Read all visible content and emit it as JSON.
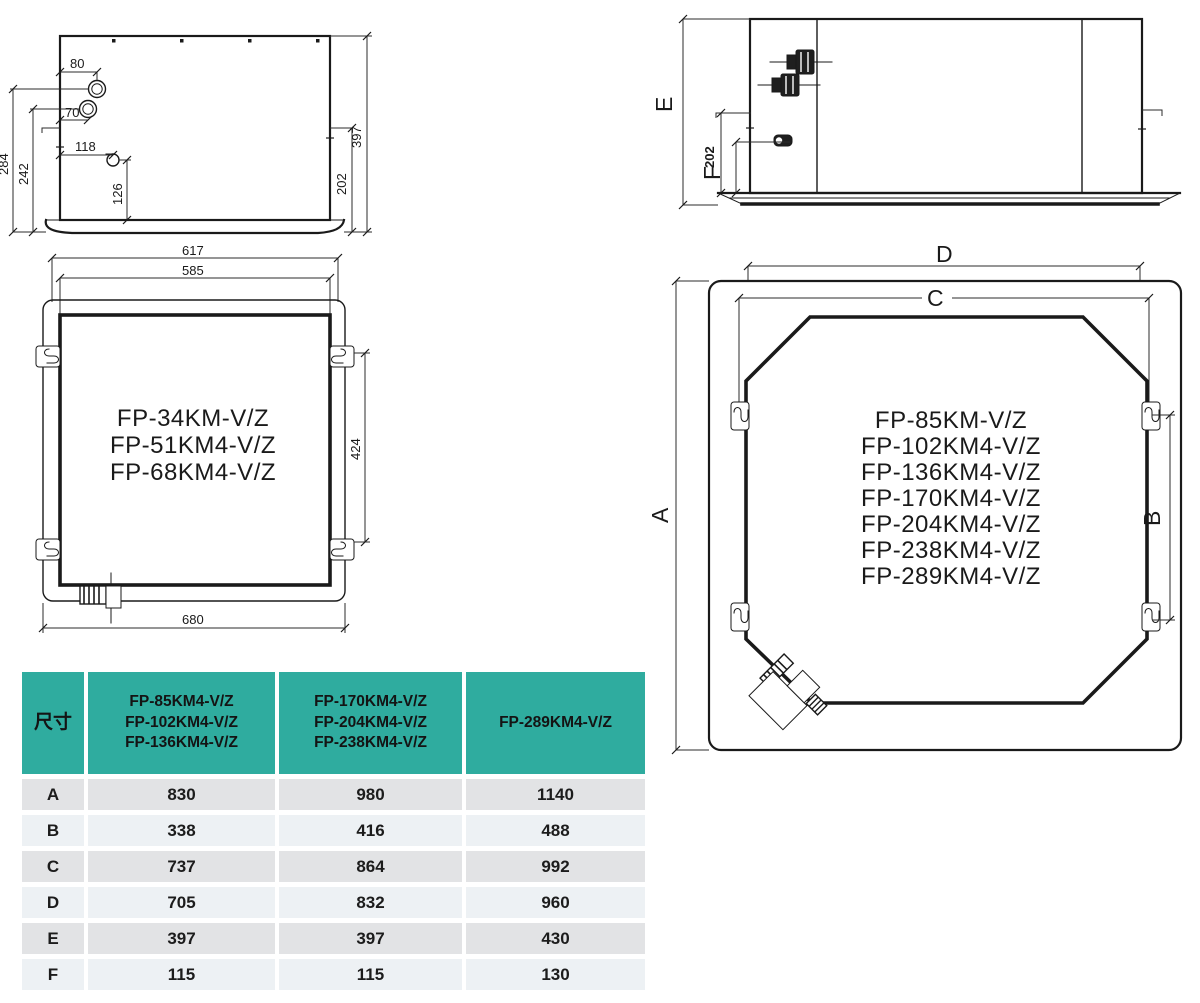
{
  "colors": {
    "accent_teal": "#2FAC9F",
    "row_shade_dark": "#E2E3E5",
    "row_shade_light": "#EDF1F4",
    "line": "#1A1A1A"
  },
  "drawings": {
    "side_small": {
      "dim_80": "80",
      "dim_70": "70",
      "dim_118": "118",
      "dim_126": "126",
      "dim_284": "284",
      "dim_242": "242",
      "dim_397": "397",
      "dim_202": "202"
    },
    "side_large": {
      "dim_E": "E",
      "dim_202": "202",
      "dim_F": "F"
    },
    "plan_small": {
      "dim_617": "617",
      "dim_585": "585",
      "dim_424": "424",
      "dim_680": "680",
      "models": [
        "FP-34KM-V/Z",
        "FP-51KM4-V/Z",
        "FP-68KM4-V/Z"
      ]
    },
    "plan_large": {
      "dim_D": "D",
      "dim_C": "C",
      "dim_A": "A",
      "dim_B": "B",
      "models": [
        "FP-85KM-V/Z",
        "FP-102KM4-V/Z",
        "FP-136KM4-V/Z",
        "FP-170KM4-V/Z",
        "FP-204KM4-V/Z",
        "FP-238KM4-V/Z",
        "FP-289KM4-V/Z"
      ]
    }
  },
  "table": {
    "col_dim_header": "尺寸",
    "col1_lines": [
      "FP-85KM4-V/Z",
      "FP-102KM4-V/Z",
      "FP-136KM4-V/Z"
    ],
    "col2_lines": [
      "FP-170KM4-V/Z",
      "FP-204KM4-V/Z",
      "FP-238KM4-V/Z"
    ],
    "col3_header": "FP-289KM4-V/Z",
    "rows": [
      {
        "label": "A",
        "values": [
          "830",
          "980",
          "1140"
        ]
      },
      {
        "label": "B",
        "values": [
          "338",
          "416",
          "488"
        ]
      },
      {
        "label": "C",
        "values": [
          "737",
          "864",
          "992"
        ]
      },
      {
        "label": "D",
        "values": [
          "705",
          "832",
          "960"
        ]
      },
      {
        "label": "E",
        "values": [
          "397",
          "397",
          "430"
        ]
      },
      {
        "label": "F",
        "values": [
          "115",
          "115",
          "130"
        ]
      }
    ]
  }
}
